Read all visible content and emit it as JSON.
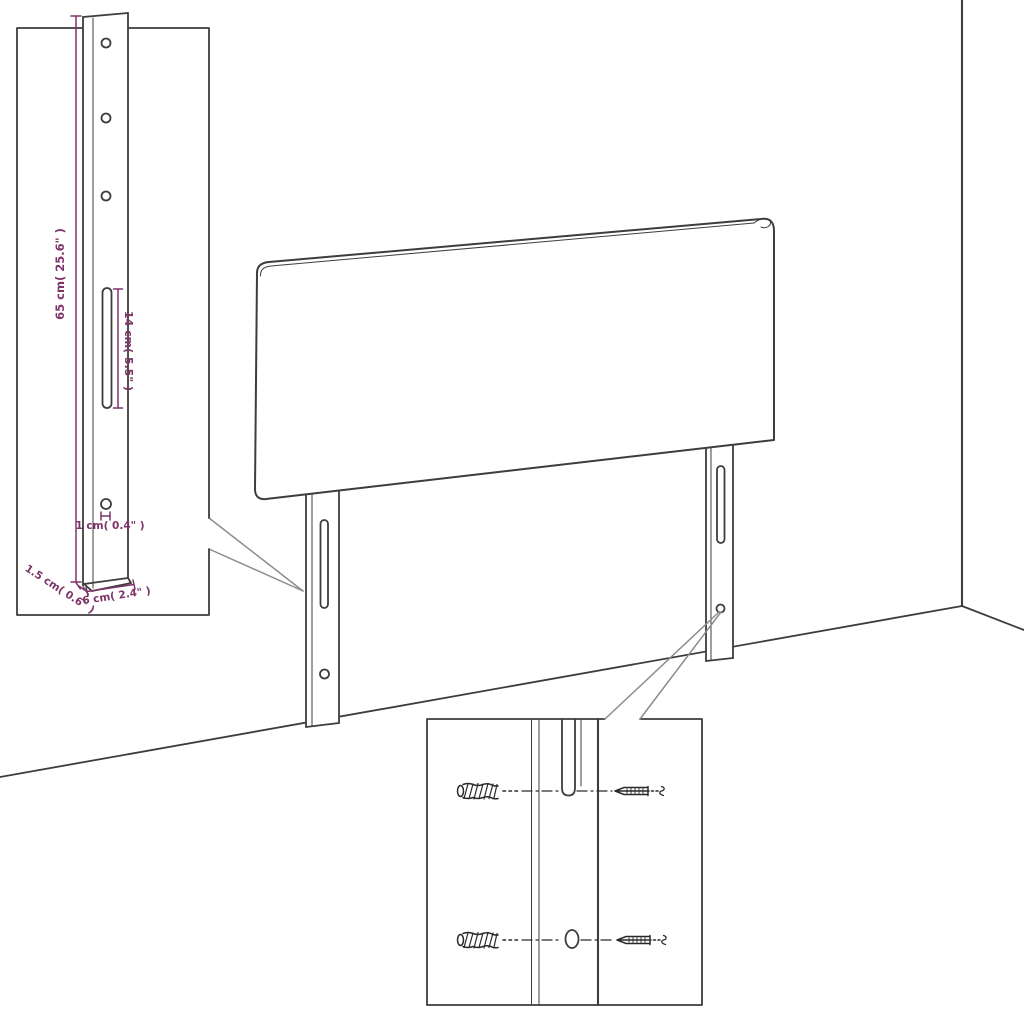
{
  "canvas": {
    "background": "#ffffff"
  },
  "colors": {
    "outline": "#3d3d3d",
    "dimension_accent": "#7d3468",
    "callout_line": "#8c8c8c",
    "hardware": "#2a2a2a"
  },
  "diagram": {
    "bracket_inset": {
      "dimension_labels": {
        "bracket_height": "65 cm( 25.6\" )",
        "slot_length": "14 cm( 5.5\" )",
        "hole_diameter": "1 cm( 0.4\" )",
        "bracket_thickness": "1.5 cm( 0.6\" )",
        "bracket_width": "6 cm( 2.4\" )"
      }
    }
  }
}
